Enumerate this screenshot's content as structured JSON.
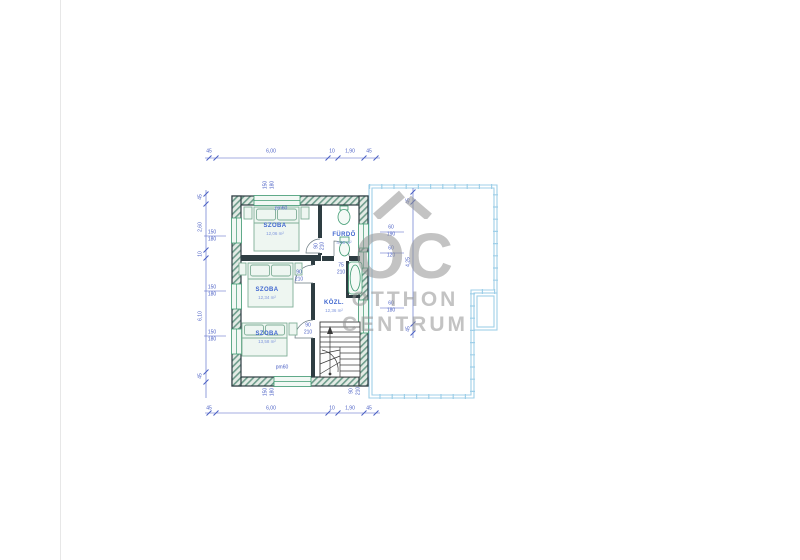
{
  "page": {
    "background": "#ffffff",
    "edge_line_color": "#e7e7e7"
  },
  "colors": {
    "dimension_text": "#4a5fc4",
    "room_text": "#3f66cf",
    "area_text": "#7e96dd",
    "wall": "#2e3d42",
    "wall_hatch": "#6d9c8b",
    "window": "#3f9b72",
    "furniture": "#7fae97",
    "terrace": "#9fcfe8",
    "watermark": "rgba(145,145,145,0.55)"
  },
  "watermark": {
    "brand": "OC",
    "line1": "OTTHON",
    "line2": "CENTRUM"
  },
  "rooms": [
    {
      "name": "SZOBA",
      "area": "12,06 m²",
      "x": 275,
      "y": 230
    },
    {
      "name": "FÜRDŐ",
      "area": "4,08 m²",
      "x": 344,
      "y": 239
    },
    {
      "name": "SZOBA",
      "area": "12,34 m²",
      "x": 267,
      "y": 294
    },
    {
      "name": "KÖZL.",
      "area": "12,36 m²",
      "x": 334,
      "y": 307
    },
    {
      "name": "SZOBA",
      "area": "13,58 m²",
      "x": 267,
      "y": 338
    }
  ],
  "dim_labels": [
    {
      "t": "45",
      "x": 209,
      "y": 152
    },
    {
      "t": "6,00",
      "x": 271,
      "y": 152
    },
    {
      "t": "10",
      "x": 332,
      "y": 152
    },
    {
      "t": "1,90",
      "x": 350,
      "y": 152
    },
    {
      "t": "45",
      "x": 369,
      "y": 152
    },
    {
      "t": "45",
      "x": 209,
      "y": 409
    },
    {
      "t": "6,00",
      "x": 271,
      "y": 409
    },
    {
      "t": "10",
      "x": 332,
      "y": 409
    },
    {
      "t": "1,90",
      "x": 350,
      "y": 409
    },
    {
      "t": "45",
      "x": 369,
      "y": 409
    },
    {
      "t": "45",
      "x": 201,
      "y": 197,
      "r": 1
    },
    {
      "t": "2,60",
      "x": 201,
      "y": 227,
      "r": 1
    },
    {
      "t": "10",
      "x": 201,
      "y": 254,
      "r": 1
    },
    {
      "t": "6,10",
      "x": 201,
      "y": 316,
      "r": 1
    },
    {
      "t": "45",
      "x": 201,
      "y": 376,
      "r": 1
    },
    {
      "t": "45",
      "x": 409,
      "y": 201,
      "r": 1
    },
    {
      "t": "4,25",
      "x": 409,
      "y": 262,
      "r": 1
    },
    {
      "t": "45",
      "x": 409,
      "y": 329,
      "r": 1
    },
    {
      "t": "150",
      "x": 212,
      "y": 233
    },
    {
      "t": "180",
      "x": 212,
      "y": 240
    },
    {
      "t": "150",
      "x": 212,
      "y": 288
    },
    {
      "t": "180",
      "x": 212,
      "y": 295
    },
    {
      "t": "150",
      "x": 212,
      "y": 333
    },
    {
      "t": "180",
      "x": 212,
      "y": 340
    },
    {
      "t": "60",
      "x": 391,
      "y": 228
    },
    {
      "t": "190",
      "x": 391,
      "y": 235
    },
    {
      "t": "60",
      "x": 391,
      "y": 249
    },
    {
      "t": "120",
      "x": 391,
      "y": 256
    },
    {
      "t": "60",
      "x": 391,
      "y": 304
    },
    {
      "t": "180",
      "x": 391,
      "y": 311
    },
    {
      "t": "90",
      "x": 299,
      "y": 273
    },
    {
      "t": "210",
      "x": 299,
      "y": 280
    },
    {
      "t": "90",
      "x": 308,
      "y": 326
    },
    {
      "t": "210",
      "x": 308,
      "y": 333
    },
    {
      "t": "75",
      "x": 341,
      "y": 266
    },
    {
      "t": "210",
      "x": 341,
      "y": 273
    },
    {
      "t": "90",
      "x": 317,
      "y": 246,
      "r": 1
    },
    {
      "t": "210",
      "x": 323,
      "y": 246,
      "r": 1
    },
    {
      "t": "pm60",
      "x": 281,
      "y": 209
    },
    {
      "t": "pm60",
      "x": 282,
      "y": 368
    },
    {
      "t": "150",
      "x": 266,
      "y": 185,
      "r": 1
    },
    {
      "t": "180",
      "x": 273,
      "y": 185,
      "r": 1
    },
    {
      "t": "150",
      "x": 266,
      "y": 392,
      "r": 1
    },
    {
      "t": "180",
      "x": 273,
      "y": 392,
      "r": 1
    },
    {
      "t": "90",
      "x": 352,
      "y": 391,
      "r": 1
    },
    {
      "t": "210",
      "x": 359,
      "y": 391,
      "r": 1
    }
  ]
}
